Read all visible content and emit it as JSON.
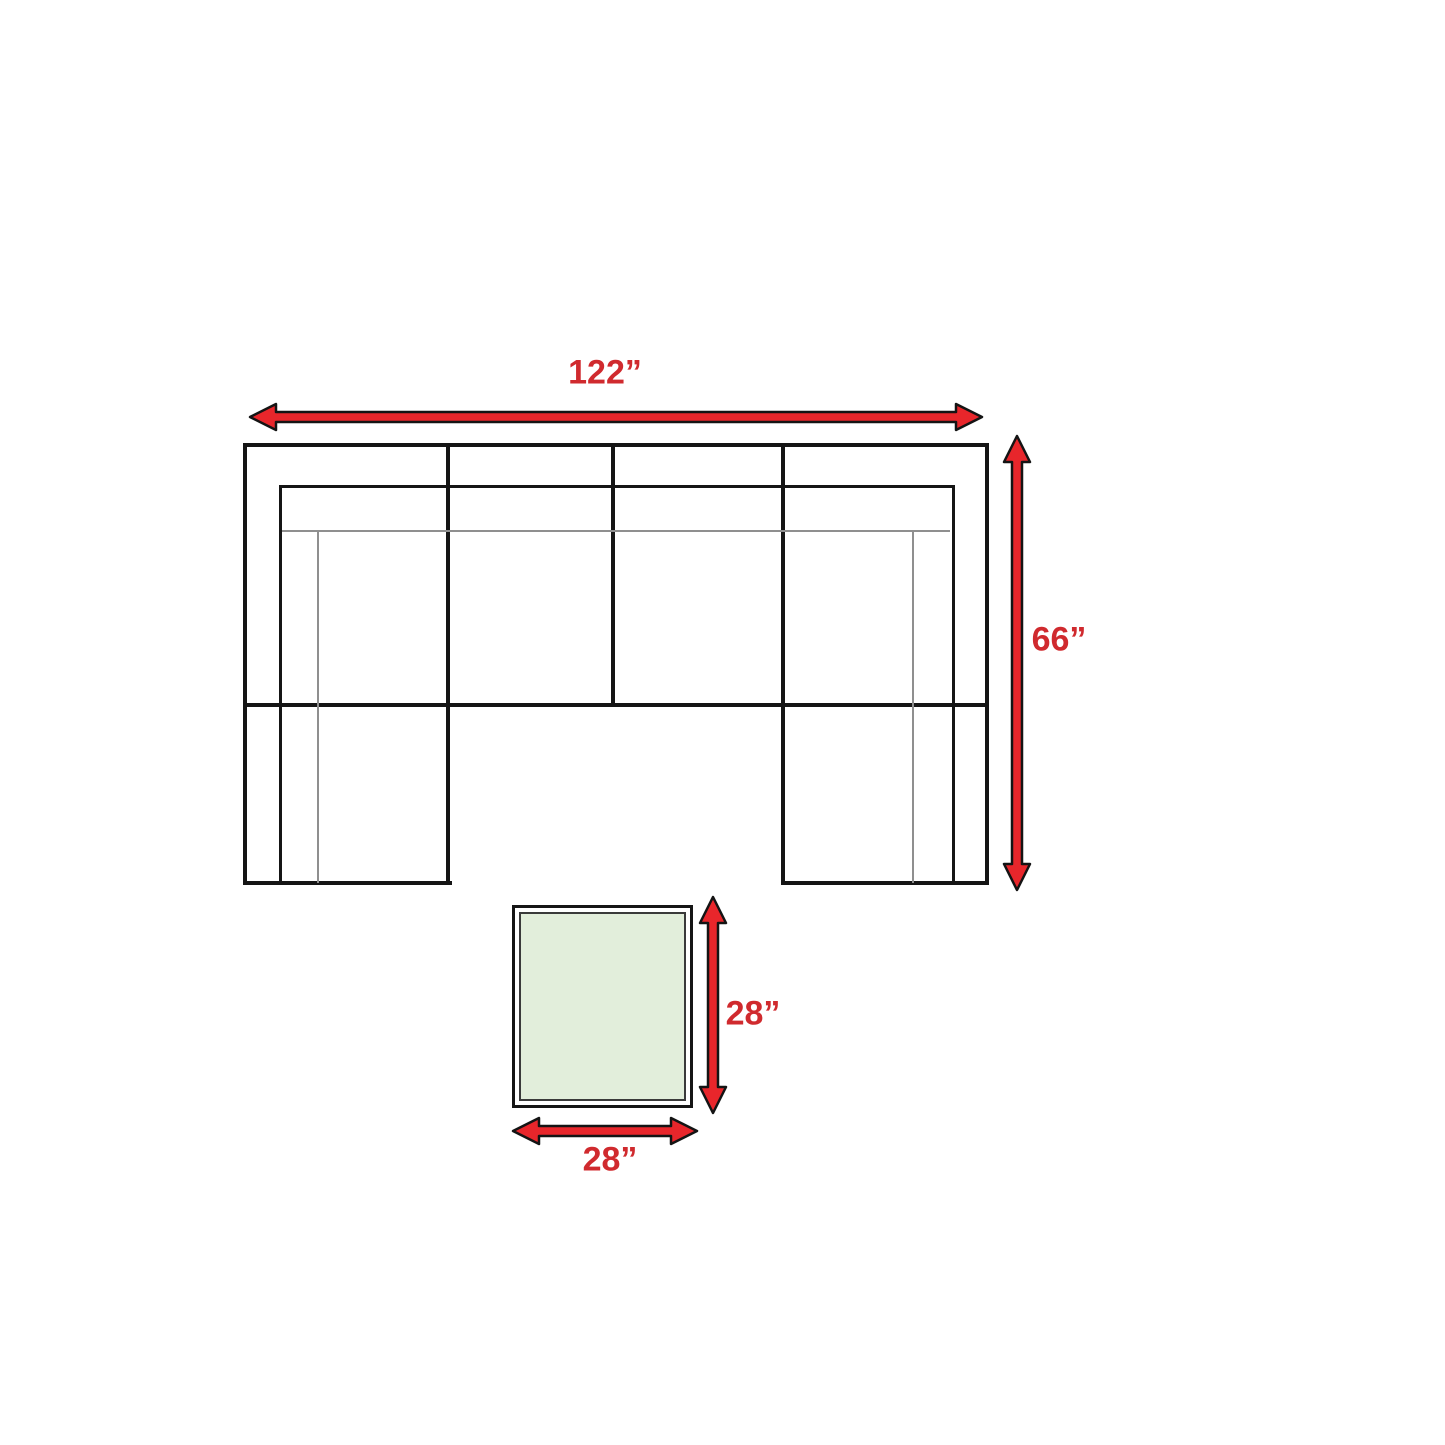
{
  "labels": {
    "sofa_width": "122”",
    "sofa_depth": "66”",
    "table_depth": "28”",
    "table_width": "28”"
  },
  "icons": {
    "sofa_width_arrow": "double-headed-horizontal-arrow",
    "sofa_depth_arrow": "double-headed-vertical-arrow",
    "table_depth_arrow": "double-headed-vertical-arrow",
    "table_width_arrow": "double-headed-horizontal-arrow"
  },
  "colors": {
    "background": "#ffffff",
    "arrow_fill": "#e8262b",
    "arrow_outline": "#141414",
    "label_red": "#d02a2e",
    "sofa_line": "#151515",
    "thin_line": "#8f8f8f",
    "table_fill": "#e2eedb"
  }
}
